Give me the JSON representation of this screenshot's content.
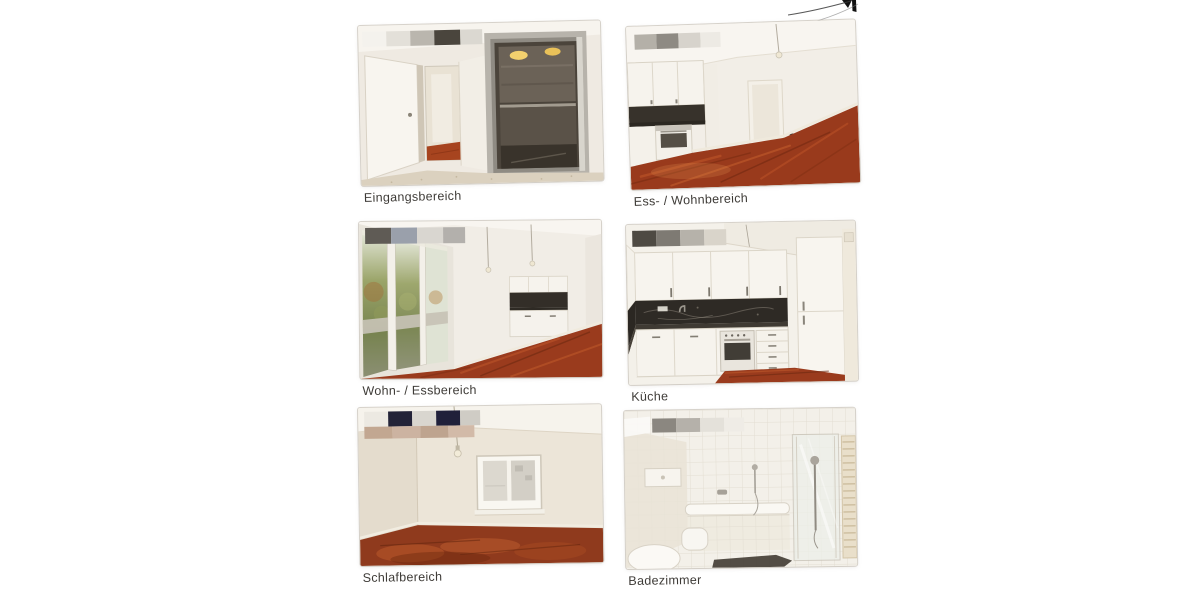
{
  "document": {
    "kind": "Scanned apartment expose photo page"
  },
  "logo_fragment": {
    "description": "clipped black logotype corner with swoosh underline",
    "color": "#111111"
  },
  "figures": [
    {
      "caption": "Eingangsbereich",
      "depicts": "entrance hall with open elevator"
    },
    {
      "caption": "Ess- / Wohnbereich",
      "depicts": "dining and living area with open kitchen and parquet floor"
    },
    {
      "caption": "Wohn- / Essbereich",
      "depicts": "living and dining area with window front and kitchenette"
    },
    {
      "caption": "Küche",
      "depicts": "white fitted kitchen with dark stone worktop and oven"
    },
    {
      "caption": "Schlafbereich",
      "depicts": "bedroom with window, pendant lamp and parquet floor"
    },
    {
      "caption": "Badezimmer",
      "depicts": "tiled bathroom with tub, glass shower and towel radiator"
    }
  ],
  "colors": {
    "paper": "#ffffff",
    "caption-ink": "#3e3b37",
    "wall": "#f1ede6",
    "wall-warm": "#ece5d8",
    "ceiling": "#f8f5f0",
    "wood": "#9a3b1d",
    "wood-light": "#c45f2e",
    "wood-dark": "#6f2a12",
    "splash": "#332e28",
    "metal": "#8b867d",
    "tile-line": "#e3ded2"
  }
}
